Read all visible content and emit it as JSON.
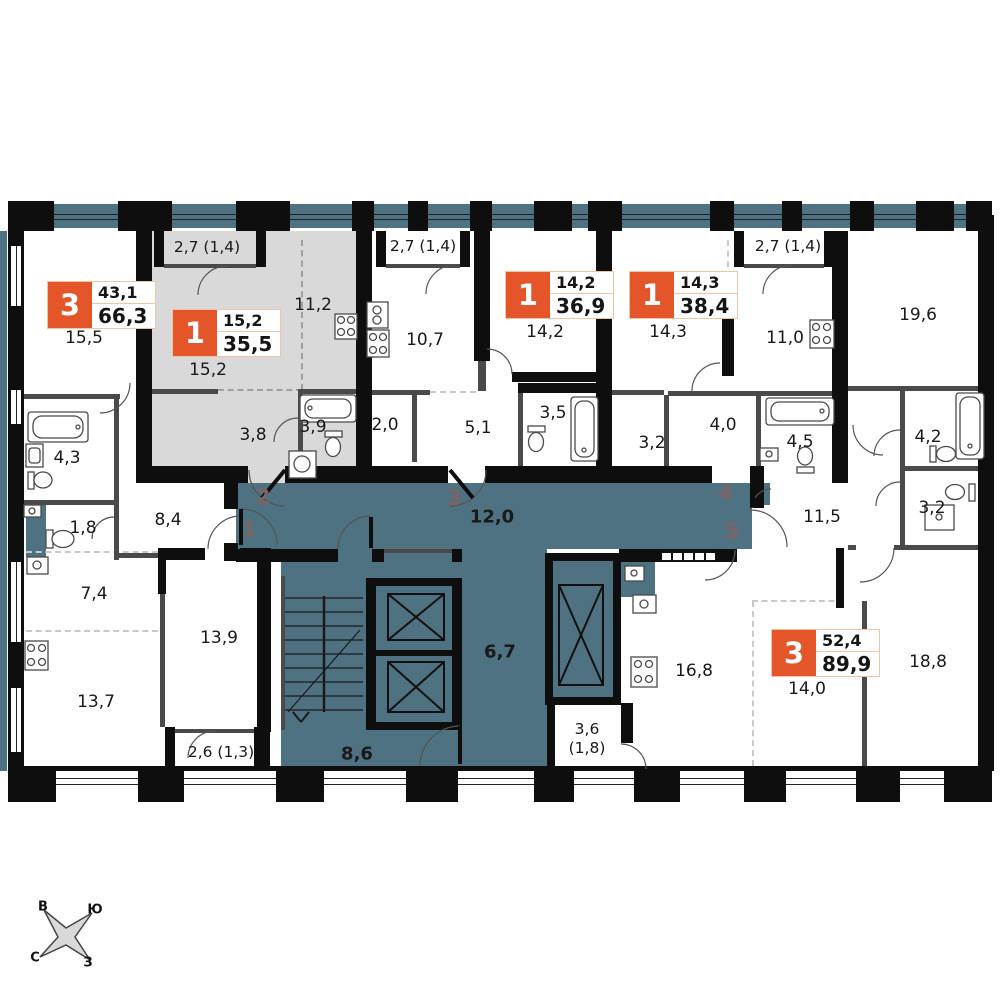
{
  "colors": {
    "corridor": "#4e7282",
    "highlight_apartment": "#d9d9d9",
    "badge_orange": "#e4562a",
    "badge_border": "#f3c3a6",
    "unit_number": "#7c6464"
  },
  "corridor": {
    "area": "12,0",
    "lobby": "6,7",
    "stairs": "8,6"
  },
  "units": {
    "u1": "1",
    "u2": "2",
    "u3": "3",
    "u4": "4",
    "u5": "5"
  },
  "compass": {
    "e": "В",
    "s": "Ю",
    "n": "С",
    "w": "З"
  },
  "apartments": [
    {
      "id": "apt-1",
      "rooms_count": "3",
      "living": "43,1",
      "total": "66,3",
      "labels": {
        "room": "15,5",
        "bath": "4,3",
        "wc": "1,8",
        "hall": "8,4",
        "kitchen": "7,4",
        "living2": "13,7",
        "bedroom": "13,9",
        "balcony": "2,6 (1,3)"
      }
    },
    {
      "id": "apt-2",
      "rooms_count": "1",
      "living": "15,2",
      "total": "35,5",
      "highlighted": true,
      "labels": {
        "balcony": "2,7 (1,4)",
        "room": "15,2",
        "kitchen": "11,2",
        "hall": "3,8",
        "bath": "3,9"
      }
    },
    {
      "id": "apt-3",
      "rooms_count": "1",
      "living": "14,2",
      "total": "36,9",
      "labels": {
        "balcony": "2,7 (1,4)",
        "kitchen": "10,7",
        "room": "14,2",
        "wardrobe": "2,0",
        "hall": "5,1",
        "bath": "3,5"
      }
    },
    {
      "id": "apt-4",
      "rooms_count": "1",
      "living": "14,3",
      "total": "38,4",
      "labels": {
        "room": "14,3",
        "hall": "3,2",
        "corridor": "4,0",
        "bath": "4,5",
        "kitchen": "11,0",
        "balcony": "2,7 (1,4)"
      }
    },
    {
      "id": "apt-5",
      "rooms_count": "3",
      "living": "52,4",
      "total": "89,9",
      "labels": {
        "room1": "19,6",
        "bath": "4,2",
        "wc": "3,2",
        "hall": "11,5",
        "kitchen": "16,8",
        "room2": "14,0",
        "room3": "18,8",
        "balcony_area": "3,6",
        "balcony_coef": "(1,8)"
      }
    }
  ]
}
